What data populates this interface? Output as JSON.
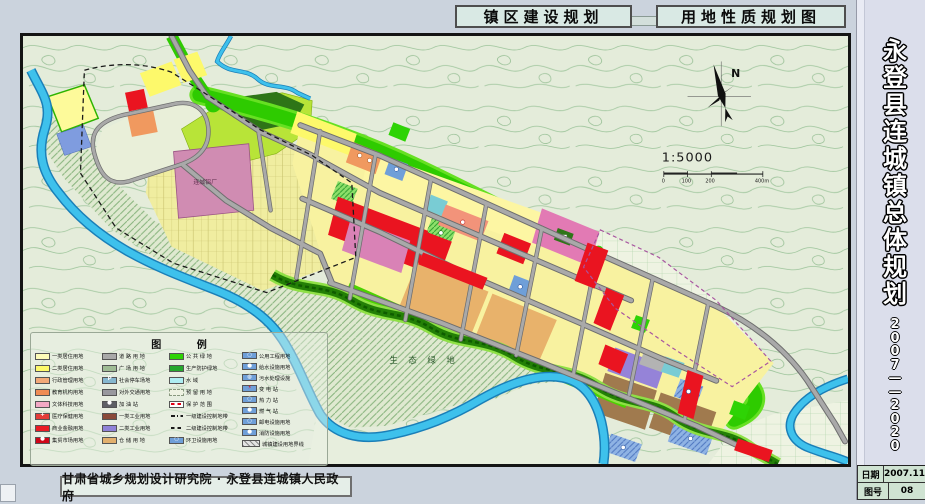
{
  "header": {
    "title_left": "镇区建设规划",
    "title_right": "用地性质规划图"
  },
  "titleblock": {
    "title_chars": [
      "永",
      "登",
      "县",
      "连",
      "城",
      "镇",
      "总",
      "体",
      "规",
      "划"
    ],
    "year_chars": [
      "2",
      "0",
      "0",
      "7",
      "—",
      "—",
      "2",
      "0",
      "2",
      "0"
    ],
    "rows": [
      {
        "label": "日期",
        "value": "2007.11"
      },
      {
        "label": "图号",
        "value": "08"
      }
    ]
  },
  "footer": {
    "credit": "甘肃省城乡规划设计研究院 · 永登县连城镇人民政府"
  },
  "map": {
    "labels": {
      "eco": "生 态 绿 地",
      "factory": "连城铝厂",
      "north": "N",
      "scale": "1:5000"
    },
    "scale_ticks": [
      "0",
      "100",
      "200",
      "400m"
    ]
  },
  "legend": {
    "title": "图 例",
    "columns": [
      {
        "items": [
          {
            "label": "一类居住用地",
            "fill": "#fdfcb8",
            "type": "solid"
          },
          {
            "label": "二类居住用地",
            "fill": "#fdf96b",
            "type": "solid"
          },
          {
            "label": "行政管理用地",
            "fill": "#f2a979",
            "type": "solid"
          },
          {
            "label": "教育机构用地",
            "fill": "#ef8c55",
            "type": "solid"
          },
          {
            "label": "文体科技用地",
            "fill": "#f2a8c4",
            "type": "solid"
          },
          {
            "label": "医疗保健用地",
            "fill": "#e43d38",
            "type": "solid",
            "glyph": "+",
            "glyphColor": "#fff"
          },
          {
            "label": "商业金融用地",
            "fill": "#ea1c25",
            "type": "solid"
          },
          {
            "label": "集贸市场用地",
            "fill": "#cf0718",
            "type": "solid",
            "glyph": "●",
            "glyphColor": "#fff"
          }
        ]
      },
      {
        "items": [
          {
            "label": "道 路 用 地",
            "fill": "#a9a9a9",
            "type": "solid"
          },
          {
            "label": "广 场 用 地",
            "fill": "#9fbc94",
            "type": "dots"
          },
          {
            "label": "社会停车场地",
            "fill": "#86b7cf",
            "type": "solid",
            "glyph": "P",
            "glyphColor": "#fff"
          },
          {
            "label": "对外交通用地",
            "fill": "#98989e",
            "type": "solid"
          },
          {
            "label": "加 油 站",
            "fill": "#5f6066",
            "type": "solid",
            "glyph": "●",
            "glyphColor": "#fff"
          },
          {
            "label": "一类工业用地",
            "fill": "#8a4a3a",
            "type": "solid"
          },
          {
            "label": "二类工业用地",
            "fill": "#8f82d8",
            "type": "solid"
          },
          {
            "label": "仓 储 用 地",
            "fill": "#e2b06e",
            "type": "solid"
          }
        ]
      },
      {
        "items": [
          {
            "label": "公 共 绿 地",
            "fill": "#2ed305",
            "type": "solid"
          },
          {
            "label": "生产防护绿地",
            "fill": "#25a82d",
            "type": "ddots"
          },
          {
            "label": "水  域",
            "fill": "#aeeef2",
            "type": "solid"
          },
          {
            "label": "预 留 用 地",
            "fill": "#eef2e2",
            "type": "dashout"
          },
          {
            "label": "保 护 范 围",
            "fill": "#ffffff",
            "type": "redash"
          },
          {
            "label": "一级建设控制地带",
            "fill": "",
            "type": "dashdot"
          },
          {
            "label": "二级建设控制地带",
            "fill": "",
            "type": "dash"
          },
          {
            "label": "环卫设施用地",
            "fill": "#6f9fd8",
            "type": "solid",
            "glyph": "○",
            "glyphColor": "#fff"
          }
        ]
      },
      {
        "items": [
          {
            "label": "公用工程用地",
            "fill": "#6f9fd8",
            "type": "solid",
            "glyph": "○",
            "glyphColor": "#fff"
          },
          {
            "label": "给水设施用地",
            "fill": "#6f9fd8",
            "type": "solid",
            "glyph": "●",
            "glyphColor": "#fff"
          },
          {
            "label": "污水处理设施",
            "fill": "#6f9fd8",
            "type": "solid",
            "glyph": "◍",
            "glyphColor": "#fff"
          },
          {
            "label": "变 电 站",
            "fill": "#6f9fd8",
            "type": "solid",
            "glyph": "⚡",
            "glyphColor": "#e00016"
          },
          {
            "label": "热 力 站",
            "fill": "#6f9fd8",
            "type": "solid",
            "glyph": "○",
            "glyphColor": "#fff"
          },
          {
            "label": "燃 气 站",
            "fill": "#6f9fd8",
            "type": "solid",
            "glyph": "●",
            "glyphColor": "#fff"
          },
          {
            "label": "邮电设施用地",
            "fill": "#6f9fd8",
            "type": "solid",
            "glyph": "○",
            "glyphColor": "#fff"
          },
          {
            "label": "消防设施用地",
            "fill": "#6f9fd8",
            "type": "solid",
            "glyph": "●",
            "glyphColor": "#fff"
          },
          {
            "label": "城镇建设用地界线",
            "fill": "",
            "type": "hatch"
          }
        ]
      }
    ]
  },
  "palette": {
    "page_margin": "#cbd3dd",
    "sidebar_bg": "#dbdeeb",
    "title_box_bg": "#d9e9e4",
    "map_paper": "#e4ecda",
    "contour_line": "#9cc49a",
    "river": "#3ec1ec",
    "river_edge": "#1a7fb8",
    "green_belt": "#2ecb00",
    "dark_green": "#2e7517",
    "lime_hill": "#b8e438",
    "residential_yellow": "#f8f2a0",
    "commercial_red": "#ea1420",
    "culture_pink": "#d982b6",
    "education_orange": "#f0995f",
    "admin_salmon": "#f2937a",
    "industry_purple": "#9583d8",
    "warehouse_brown": "#a07a4e",
    "warehouse_tan": "#e8b26b",
    "utility_blue": "#6f9fd8",
    "road_gray": "#a9a9a9"
  }
}
